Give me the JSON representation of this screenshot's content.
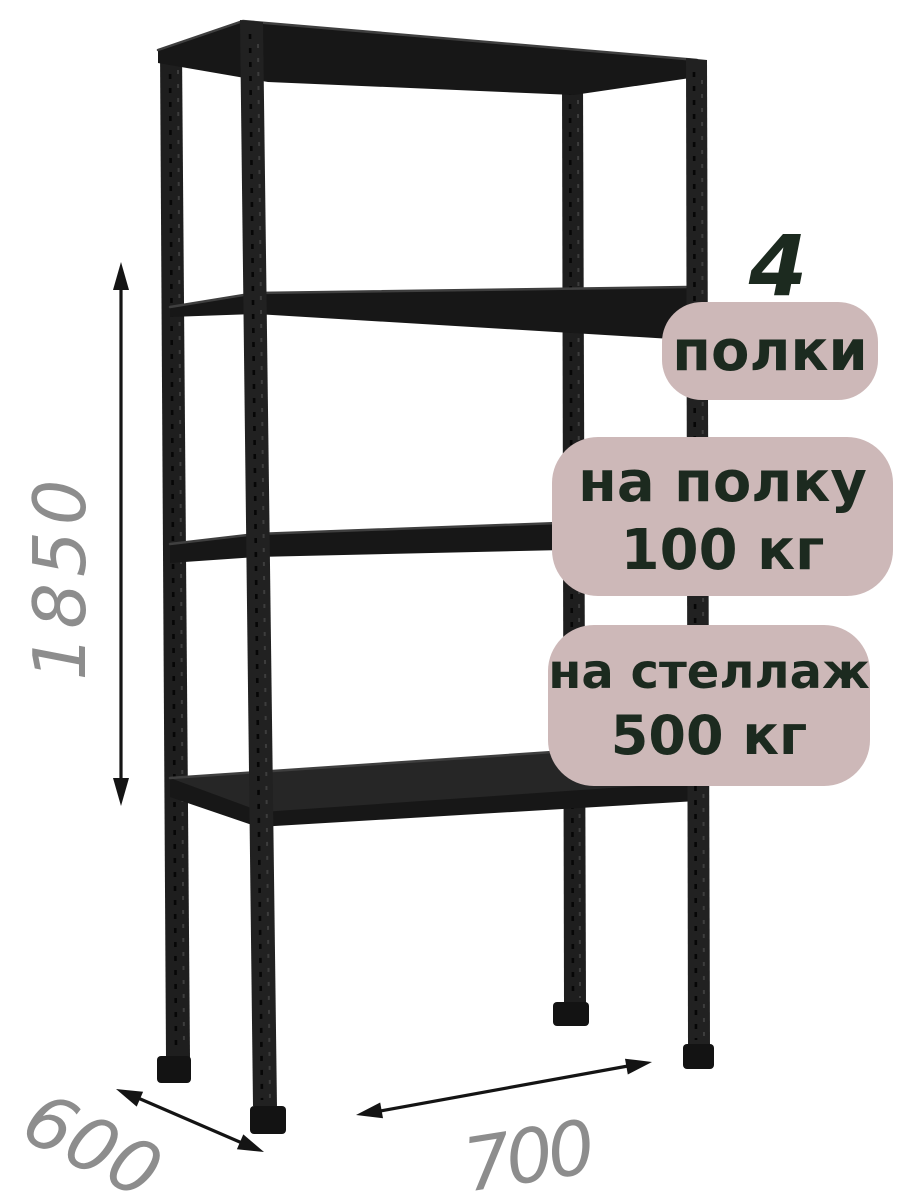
{
  "badges": {
    "shelf_count": {
      "number": "4",
      "label": "полки"
    },
    "per_shelf_load": {
      "line1": "на полку",
      "line2": "100 кг"
    },
    "per_rack_load": {
      "line1": "на стеллаж",
      "line2": "500 кг"
    }
  },
  "dimensions": {
    "height_mm": "1850",
    "depth_mm": "600",
    "width_mm": "700"
  },
  "rack": {
    "shelves_count": 4
  },
  "colors": {
    "bg": "#ffffff",
    "metal": "#1e1e1e",
    "badge_bg": "#cdb8b8",
    "badge_text": "#1c2a1f",
    "dim": "#8d8d8d",
    "arrow": "#141414"
  }
}
